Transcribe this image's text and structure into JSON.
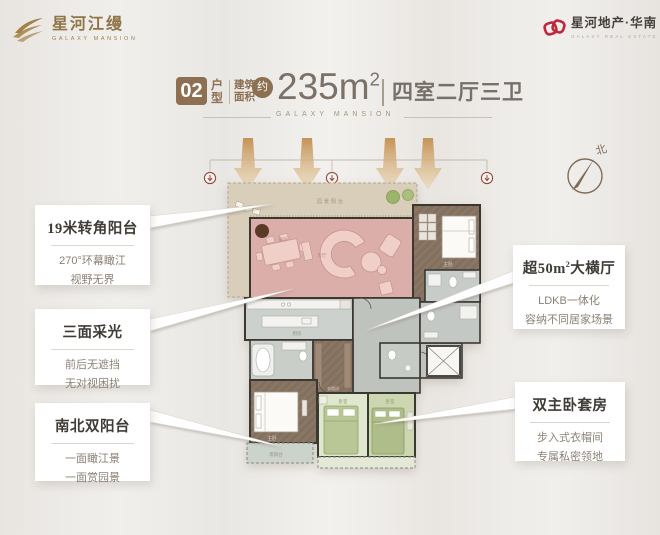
{
  "brand": {
    "logo_title": "星河江缦",
    "logo_subtitle": "GALAXY MANSION",
    "dev_name": "星河地产·华南",
    "dev_subtitle": "GALAXY REAL ESTATE"
  },
  "header": {
    "unit_number": "02",
    "unit_label": "户型",
    "area_label": "建筑面积",
    "approx": "约",
    "area_value": "235m",
    "area_sup": "2",
    "rooms_text": "四室二厅三卫",
    "watermark": "GALAXY MANSION"
  },
  "callouts": {
    "left": [
      {
        "title": "19米转角阳台",
        "lines": [
          "270°环幕瞰江",
          "视野无界"
        ]
      },
      {
        "title": "三面采光",
        "lines": [
          "前后无遮挡",
          "无对视困扰"
        ]
      },
      {
        "title": "南北双阳台",
        "lines": [
          "一面瞰江景",
          "一面赏园景"
        ]
      }
    ],
    "right": [
      {
        "title_pre": "超50m",
        "title_sup": "2",
        "title_post": "大横厅",
        "lines": [
          "LDKB一体化",
          "容纳不同居家场景"
        ]
      },
      {
        "title": "双主卧套房",
        "lines": [
          "步入式衣帽间",
          "专属私密领地"
        ]
      }
    ]
  },
  "compass": {
    "north": "北"
  },
  "plan": {
    "rooms": [
      {
        "name": "terrace",
        "label": "园景阳台"
      },
      {
        "name": "dining",
        "label": "餐厅"
      },
      {
        "name": "living",
        "label": "客厅"
      },
      {
        "name": "bedroom-2",
        "label": "主卧"
      },
      {
        "name": "kitchen",
        "label": "厨房"
      },
      {
        "name": "walk-in-closet",
        "label": "衣帽间"
      },
      {
        "name": "master-bedroom",
        "label": "主卧"
      },
      {
        "name": "south-balcony",
        "label": "南阳台"
      },
      {
        "name": "bedroom-3",
        "label": "卧室"
      },
      {
        "name": "bedroom-4",
        "label": "卧室"
      }
    ]
  },
  "colors": {
    "brand_gold": "#8f7446",
    "brand_red": "#c0273a",
    "header_brown": "#8d6f51",
    "headline_gray": "#7b7168",
    "living_pink": "#dcaeaa",
    "terrace_beige": "#d8ceba",
    "wood_brown": "#8b7664",
    "bedroom_green": "#b9c796",
    "wall_dark": "#3b3733",
    "marker_maroon": "#96463f"
  }
}
